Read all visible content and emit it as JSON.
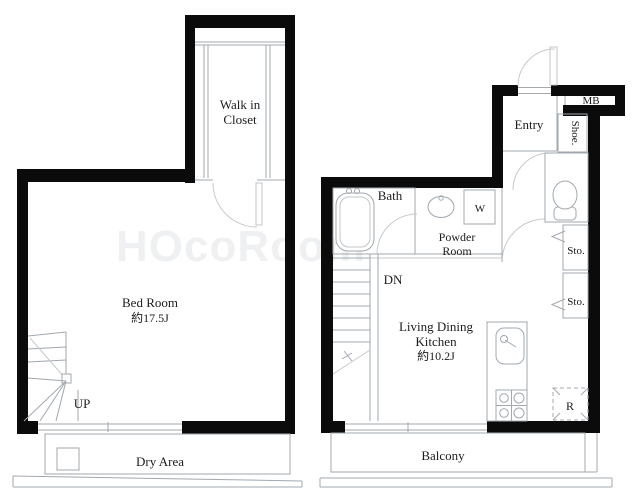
{
  "title": "Apartment floor plan",
  "colors": {
    "wall": "#0b0b0b",
    "thin_line": "#a2a8ae",
    "light_line": "#c6cacd",
    "text": "#1c1c1c",
    "background": "#ffffff"
  },
  "upper_floor": {
    "walk_in_closet": {
      "line1": "Walk in",
      "line2": "Closet"
    },
    "bed_room": {
      "name": "Bed Room",
      "size": "約17.5J"
    },
    "stairs_label": "UP",
    "dry_area_label": "Dry Area"
  },
  "lower_floor": {
    "entry_label": "Entry",
    "meter_box_label": "MB",
    "shoe_label": "Shoe.",
    "bath_label": "Bath",
    "powder_room": {
      "line1": "Powder",
      "line2": "Room"
    },
    "washer_label": "W",
    "stairs_label": "DN",
    "storage1_label": "Sto.",
    "storage2_label": "Sto.",
    "ldk": {
      "line1": "Living Dining",
      "line2": "Kitchen",
      "size": "約10.2J"
    },
    "refrigerator_label": "R",
    "balcony_label": "Balcony"
  },
  "watermark": "HOcoRoom"
}
